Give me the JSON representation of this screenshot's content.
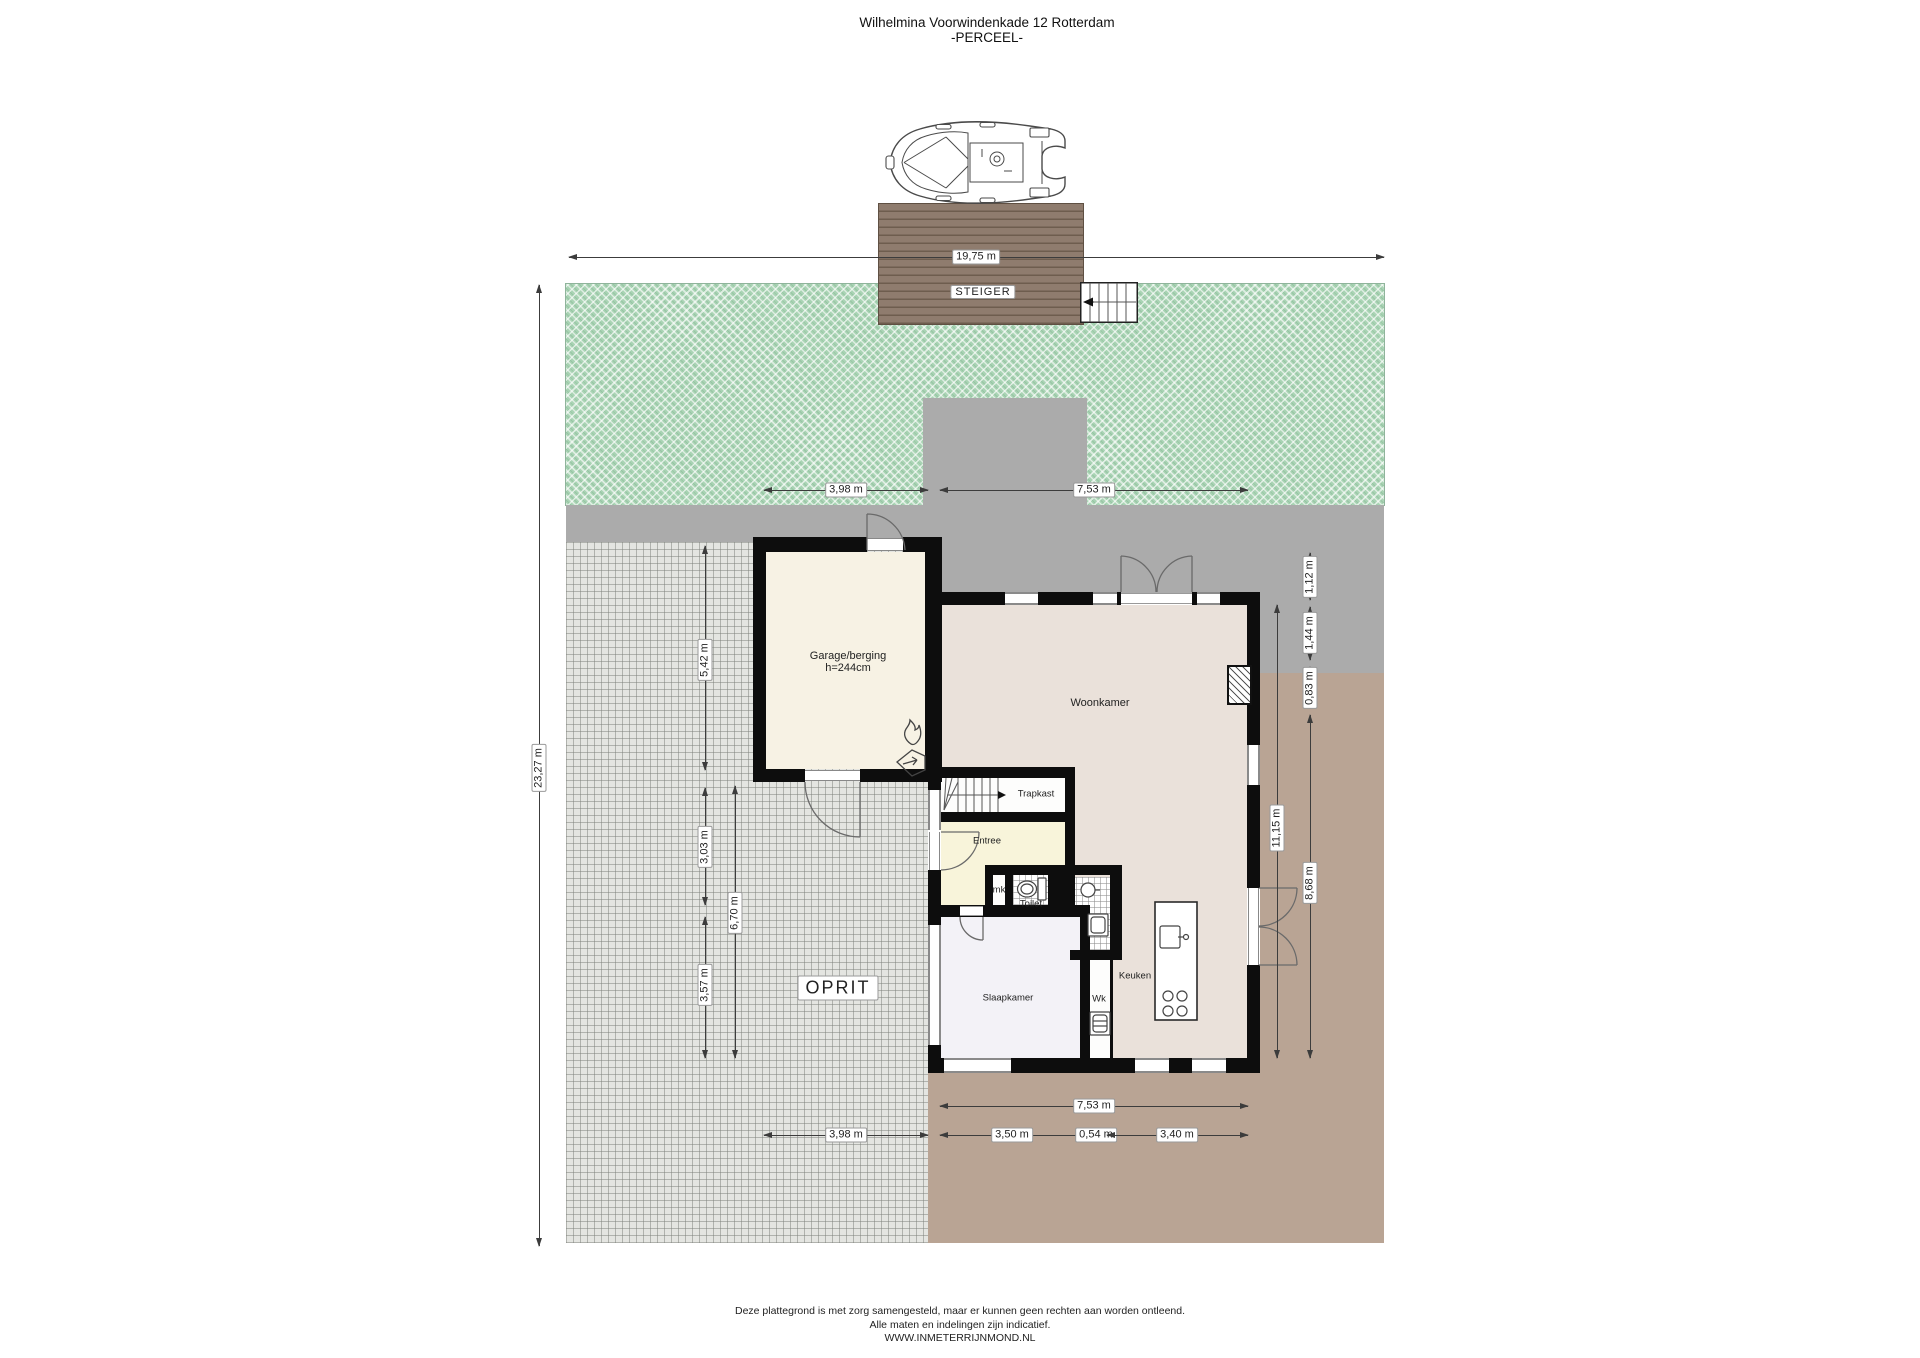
{
  "title": {
    "line1": "Wilhelmina Voorwindenkade 12 Rotterdam",
    "line2": "-PERCEEL-"
  },
  "site_labels": {
    "steiger": "STEIGER",
    "oprit": "OPRIT"
  },
  "rooms": {
    "garage_name": "Garage/berging",
    "garage_note": "h=244cm",
    "woonkamer": "Woonkamer",
    "trapkast": "Trapkast",
    "entree": "Entree",
    "mk": "mk",
    "toilet": "Toilet",
    "keuken": "Keuken",
    "slaapkamer": "Slaapkamer",
    "wk": "Wk"
  },
  "dimensions": {
    "water_width": "19,75 m",
    "plot_height": "23,27 m",
    "garage_top_width": "3,98 m",
    "house_top_width": "7,53 m",
    "garage_side_height": "5,42 m",
    "mid_left_height": "3,03 m",
    "bedroom_side_height": "3,57 m",
    "left_total_height": "6,70 m",
    "right_offset_1": "1,12 m",
    "right_offset_2": "1,44 m",
    "right_offset_3": "0,83 m",
    "right_house_height": "11,15 m",
    "right_lower_height": "8,68 m",
    "house_bottom_width": "7,53 m",
    "garage_bottom_width": "3,98 m",
    "bedroom_width": "3,50 m",
    "wk_width": "0,54 m",
    "kitchen_width": "3,40 m"
  },
  "footer": {
    "line1": "Deze plattegrond is met zorg samengesteld, maar er kunnen geen rechten aan worden ontleend.",
    "line2": "Alle maten en indelingen zijn indicatief.",
    "line3": "WWW.INMETERRIJNMOND.NL"
  },
  "icons": {
    "boat": "boat-top-view",
    "dock_stairs": "dock-stairs",
    "flame": "heater-flame-icon",
    "vent": "ventilation-unit-icon",
    "toilet": "toilet-fixture",
    "sink": "washbasin",
    "shower": "shower-tray",
    "washer": "washing-machine",
    "island_sink": "kitchen-sink",
    "burners": "cooktop-burners",
    "chimney": "chimney-hatch"
  },
  "colors": {
    "grass_green": "#a9d4b4",
    "road_gray": "#ababab",
    "terrace_brown": "#b9a494",
    "dock_brown": "#8f7c6e",
    "wall_black": "#0d0d0d",
    "garage_floor": "#f7f2e4",
    "living_floor": "#eae1da",
    "entree_floor": "#f8f4da",
    "bedroom_floor": "#f3f2f7"
  }
}
